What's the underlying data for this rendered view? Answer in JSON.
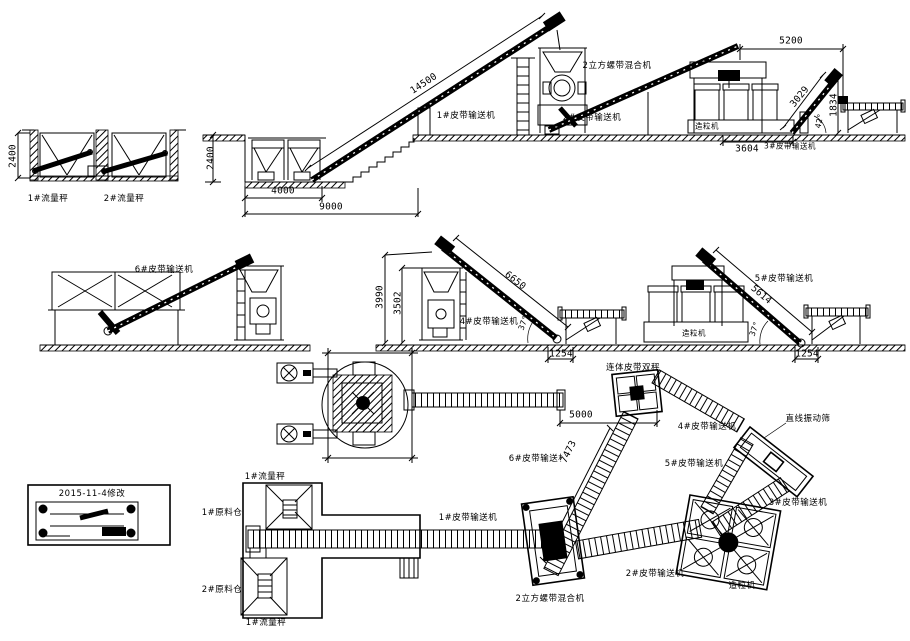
{
  "colors": {
    "ink": "#000000",
    "paper": "#ffffff"
  },
  "revision_note": "2015-11-4修改",
  "row1": {
    "scales_view": {
      "dim_height": "2400",
      "scale1": "1#流量秤",
      "scale2": "2#流量秤"
    },
    "pit_view": {
      "dim_height": "2400",
      "dim_incline": "14500",
      "dim_pit_width": "4000",
      "dim_overall": "9000",
      "conveyor1": "1#皮带输送机"
    },
    "mixer": "2立方螺带混合机",
    "conveyor2": "2#皮带输送机",
    "granulator_view": {
      "dim_span": "5200",
      "granulator": "造粒机",
      "dim_incline": "3029",
      "dim_height": "1834",
      "angle": "42°",
      "dim_base": "3604",
      "conveyor3": "3#皮带输送机"
    }
  },
  "row2": {
    "conveyor6": "6#皮带输送机",
    "tower_view": {
      "dim_height_outer": "3990",
      "dim_height_inner": "3502",
      "dim_incline": "6650",
      "angle": "37°",
      "conveyor4": "4#皮带输送机",
      "dim_base": "1254"
    },
    "granulator_view": {
      "conveyor5": "5#皮带输送机",
      "granulator": "造粒机",
      "dim_incline": "5614",
      "angle": "37°",
      "dim_base": "1254"
    }
  },
  "plan_mid": {
    "double_scale": "连体皮带双秤",
    "dim_span": "5000",
    "conveyor6": "6#皮带输送机",
    "dim_conveyor6": "7473",
    "conveyor4": "4#皮带输送机",
    "conveyor5": "5#皮带输送机",
    "screen": "直线振动筛",
    "conveyor3": "3#皮带输送机"
  },
  "plan_bottom": {
    "scale_top": "1#流量秤",
    "bin1": "1#原料仓",
    "bin2": "2#原料仓",
    "scale_bottom": "1#流量秤",
    "conveyor1": "1#皮带输送机",
    "mixer": "2立方螺带混合机",
    "conveyor2": "2#皮带输送机",
    "granulator": "造粒机",
    "conveyor3": "3#皮带输送机"
  }
}
